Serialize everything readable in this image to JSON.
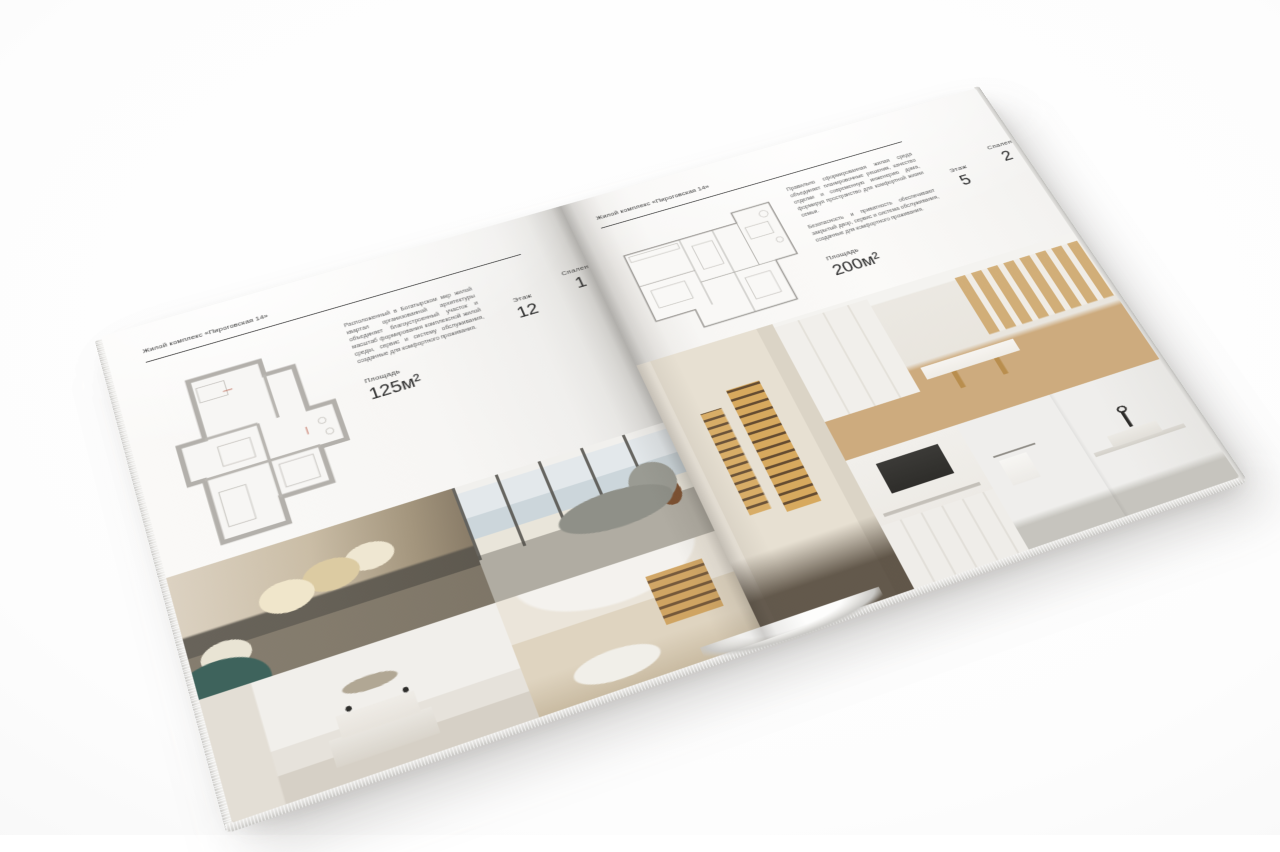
{
  "background_color": "#ffffff",
  "left_page": {
    "header": "Жилой комплекс «Пироговская 14»",
    "description": "Расположенный в Богатырском мкр жилой квартал организованной архитектуры объединяет благоустроенный участок и масштаб формирования комплексной жилой среды, сервис и систему обслуживания, созданные для комфортного проживания.",
    "stats": [
      {
        "label": "Площадь",
        "value": "125м²"
      },
      {
        "label": "Этаж",
        "value": "12"
      },
      {
        "label": "Спален",
        "value": "1"
      }
    ]
  },
  "right_page": {
    "header": "Жилой комплекс «Пироговская 14»",
    "description_1": "Правильно сформированная жилая среда объединяет планировочные решения, качество отделки и современную инженерию дома, формируя пространство для комфортной жизни семьи.",
    "description_2": "Безопасность и приватность обеспечивают закрытый двор, сервис и система обслуживания, созданные для комфортного проживания.",
    "stats": [
      {
        "label": "Площадь",
        "value": "200м²"
      },
      {
        "label": "Этаж",
        "value": "5"
      },
      {
        "label": "Спален",
        "value": "2"
      }
    ]
  },
  "photos": {
    "left": [
      "bedroom-with-pillows",
      "living-room-panoramic-windows",
      "white-bedroom",
      "reading-nook-lit-shelves"
    ],
    "right": [
      "wardrobe-lit-shelves",
      "dressing-room-desk",
      "kitchen-detail",
      "bathroom-sink"
    ]
  },
  "colors": {
    "page": "#f8f7f5",
    "ink": "#2e2e2e",
    "muted_text": "#5d5d5d",
    "rule": "#3a3a3a",
    "plan_wall_gray": "#b3b0ab",
    "photo_amber": "#d2a05e",
    "photo_teal": "#3e635c",
    "photo_beige": "#cabda6",
    "photo_wood": "#cdab7e"
  }
}
